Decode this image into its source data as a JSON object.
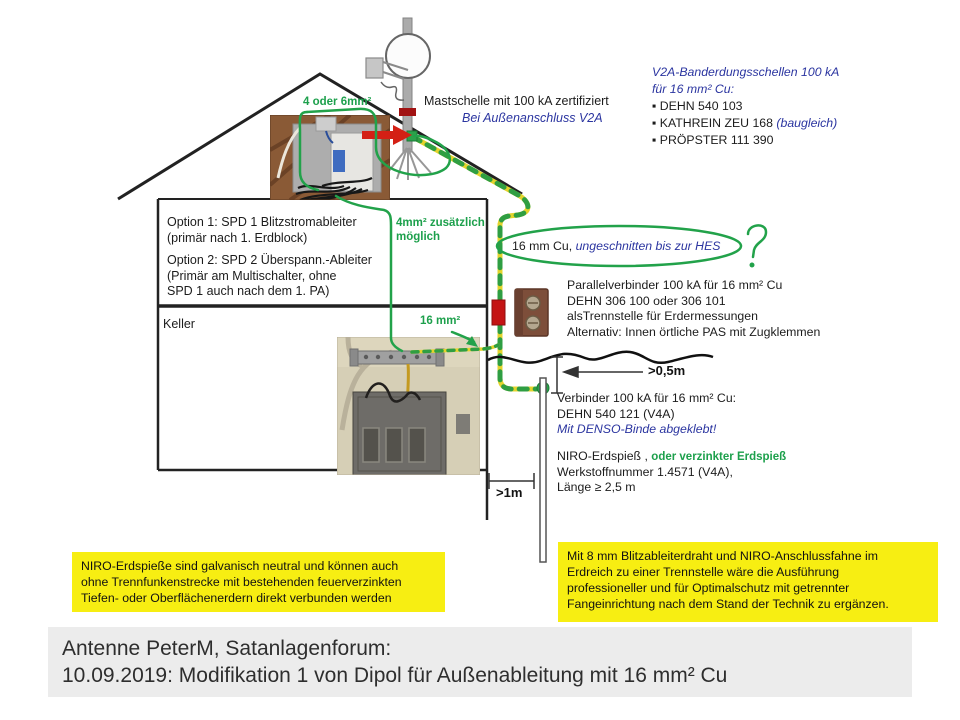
{
  "colors": {
    "annotation_green": "#1da04c",
    "note_blue": "#2b35a0",
    "highlight_yellow": "#f7ee12",
    "cable_yellow": "#e3d42c",
    "cable_green": "#2f9e42",
    "accent_red": "#d42015"
  },
  "v2a_block": {
    "title1": "V2A-Banderdungsschellen 100 kA",
    "title2": "für 16 mm² Cu:",
    "bullet": "▪",
    "item1": "DEHN 540 103",
    "item2": "KATHREIN ZEU 168 ",
    "item2_note": "(baugleich)",
    "item3": "PRÖPSTER 111 390"
  },
  "mast": {
    "label": "Mastschelle  mit 100 kA zertifiziert",
    "note": "Bei Außenanschluss V2A"
  },
  "wires": {
    "attic": "4 oder 6mm²",
    "extra1": "4mm² zusätzlich",
    "extra2": "möglich",
    "basement": "16 mm²"
  },
  "options_block": {
    "line1": "Option 1: SPD 1 Blitzstromableiter",
    "line2": "(primär nach 1. Erdblock)",
    "line3": "Option 2: SPD 2 Überspann.-Ableiter",
    "line4": "(Primär am Multischalter, ohne",
    "line5": "SPD 1 auch nach dem 1. PA)"
  },
  "hes_note": {
    "black": "16 mm Cu, ",
    "blue": "ungeschnitten  bis zur HES"
  },
  "parallel_block": {
    "line1": "Parallelverbinder 100 kA für 16 mm²  Cu",
    "line2": "DEHN 306 100 oder 306 101",
    "line3": "alsTrennstelle für Erdermessungen",
    "line4": "Alternativ: Innen örtliche PAS mit Zugklemmen"
  },
  "dimensions": {
    "ground_offset": ">0,5m",
    "rod_offset": ">1m"
  },
  "verbinder_block": {
    "line1": "Verbinder 100 kA für 16 mm² Cu:",
    "line2": "DEHN 540 121 (V4A)",
    "line3": "Mit DENSO-Binde abgeklebt!"
  },
  "niro_block": {
    "line1_black": "NIRO-Erdspieß , ",
    "line1_green": "oder verzinkter Erdspieß",
    "line2": "Werkstoffnummer 1.4571 (V4A),",
    "line3": "Länge ≥ 2,5 m"
  },
  "house": {
    "keller": "Keller"
  },
  "note_left": {
    "line1": "NIRO-Erdspieße sind galvanisch neutral und können auch",
    "line2": "ohne Trennfunkenstrecke mit bestehenden feuerverzinkten",
    "line3": "Tiefen- oder Oberflächenerdern direkt verbunden werden"
  },
  "note_right": {
    "line1": "Mit 8 mm Blitzableiterdraht und NIRO-Anschlussfahne im",
    "line2": "Erdreich zu einer Trennstelle wäre die Ausführung",
    "line3": "professioneller und für Optimalschutz mit getrennter",
    "line4": "Fangeinrichtung nach dem Stand der Technik zu ergänzen."
  },
  "caption": {
    "line1": "Antenne PeterM, Satanlagenforum:",
    "line2": "10.09.2019: Modifikation 1 von Dipol für Außenableitung mit 16 mm² Cu"
  }
}
